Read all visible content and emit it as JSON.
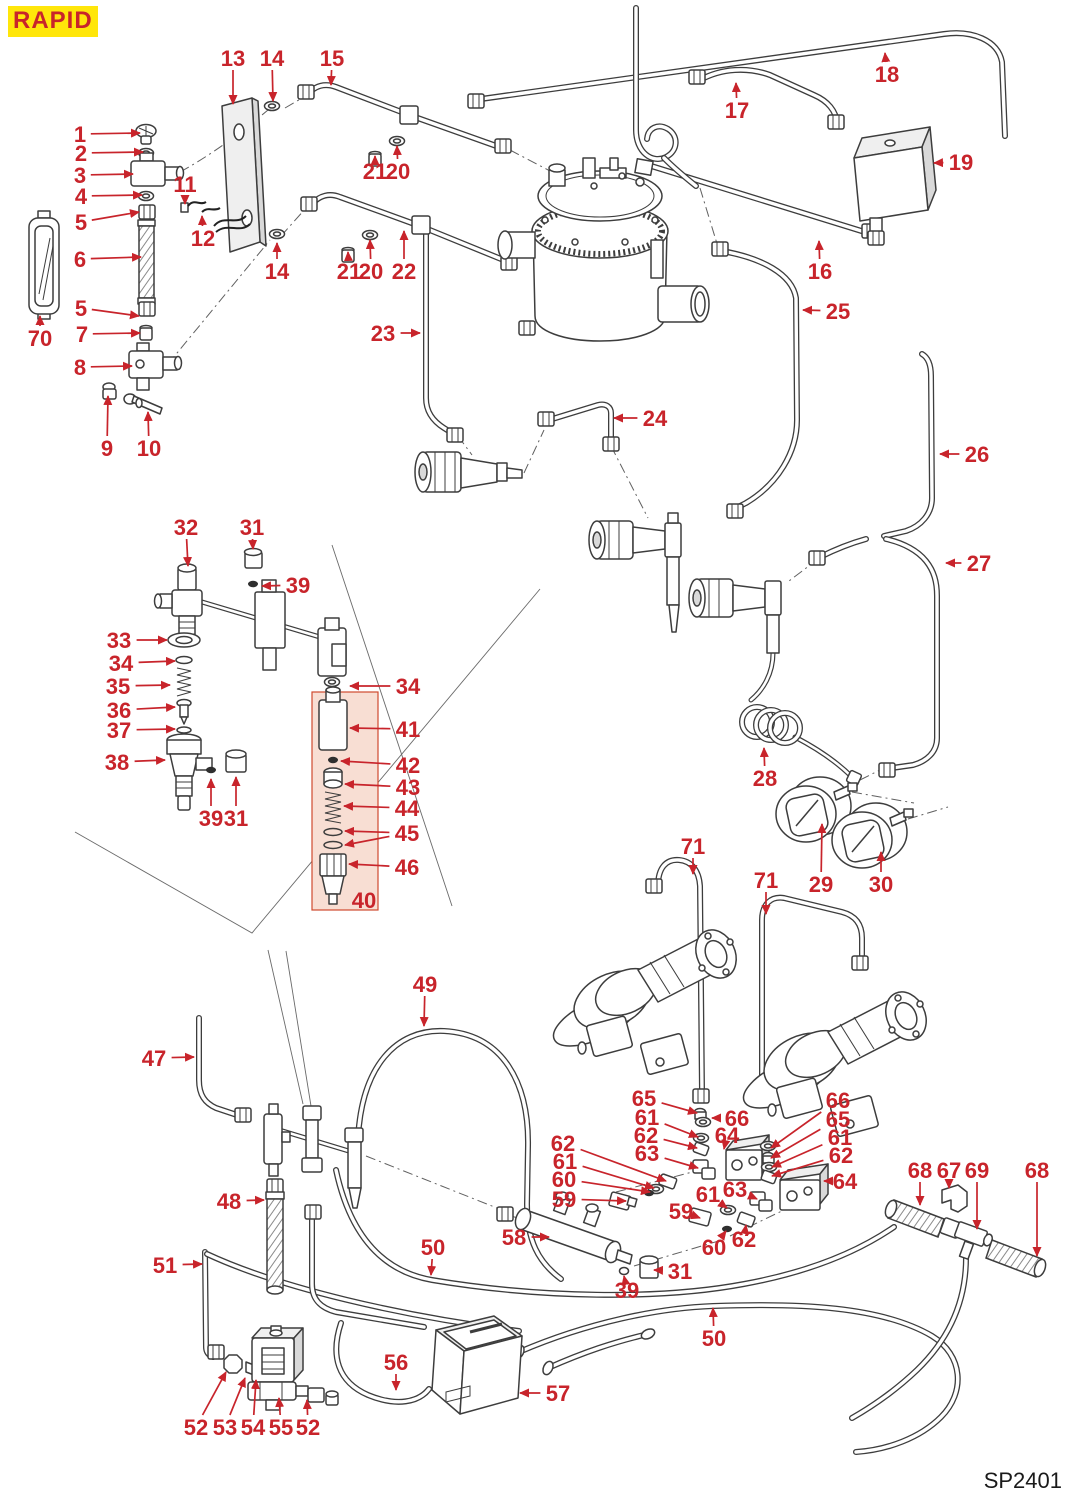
{
  "header": {
    "brand": "RAPID",
    "brand_bg": "#ffe60a",
    "brand_color": "#c8242b"
  },
  "footer": {
    "plate_code": "SP2401"
  },
  "colors": {
    "callout": "#c8242b",
    "line_art": "#3d3d3d",
    "highlight_box_fill": "#f8ded3",
    "highlight_box_border": "#cf4a2e"
  },
  "highlight_box": {
    "x": 312,
    "y": 692,
    "w": 66,
    "h": 218,
    "contains_items": "40-46"
  },
  "callouts": [
    {
      "t": "1",
      "x": 80,
      "y": 134,
      "tips": [
        [
          140,
          133
        ]
      ]
    },
    {
      "t": "2",
      "x": 81,
      "y": 153,
      "tips": [
        [
          143,
          152
        ]
      ]
    },
    {
      "t": "3",
      "x": 80,
      "y": 175,
      "tips": [
        [
          133,
          174
        ]
      ]
    },
    {
      "t": "4",
      "x": 81,
      "y": 196,
      "tips": [
        [
          142,
          195
        ]
      ]
    },
    {
      "t": "5",
      "x": 81,
      "y": 222,
      "tips": [
        [
          139,
          212
        ]
      ]
    },
    {
      "t": "6",
      "x": 80,
      "y": 259,
      "tips": [
        [
          141,
          257
        ]
      ]
    },
    {
      "t": "70",
      "x": 40,
      "y": 338,
      "tips": [
        [
          40,
          316
        ]
      ]
    },
    {
      "t": "5",
      "x": 81,
      "y": 308,
      "tips": [
        [
          139,
          316
        ]
      ]
    },
    {
      "t": "7",
      "x": 82,
      "y": 334,
      "tips": [
        [
          140,
          333
        ]
      ]
    },
    {
      "t": "8",
      "x": 80,
      "y": 367,
      "tips": [
        [
          132,
          366
        ]
      ]
    },
    {
      "t": "9",
      "x": 107,
      "y": 448,
      "tips": [
        [
          108,
          396
        ]
      ]
    },
    {
      "t": "10",
      "x": 149,
      "y": 448,
      "tips": [
        [
          148,
          412
        ]
      ]
    },
    {
      "t": "11",
      "x": 185,
      "y": 184,
      "tips": [
        [
          185,
          204
        ]
      ]
    },
    {
      "t": "12",
      "x": 203,
      "y": 238,
      "tips": [
        [
          202,
          216
        ]
      ]
    },
    {
      "t": "13",
      "x": 233,
      "y": 58,
      "tips": [
        [
          233,
          104
        ]
      ]
    },
    {
      "t": "14",
      "x": 272,
      "y": 58,
      "tips": [
        [
          273,
          101
        ]
      ]
    },
    {
      "t": "15",
      "x": 332,
      "y": 58,
      "tips": [
        [
          331,
          85
        ]
      ]
    },
    {
      "t": "14",
      "x": 277,
      "y": 271,
      "tips": [
        [
          277,
          243
        ]
      ]
    },
    {
      "t": "21",
      "x": 375,
      "y": 171,
      "tips": [
        [
          375,
          156
        ]
      ]
    },
    {
      "t": "20",
      "x": 398,
      "y": 171,
      "tips": [
        [
          397,
          146
        ]
      ]
    },
    {
      "t": "21",
      "x": 349,
      "y": 271,
      "tips": [
        [
          348,
          252
        ]
      ]
    },
    {
      "t": "20",
      "x": 371,
      "y": 271,
      "tips": [
        [
          370,
          240
        ]
      ]
    },
    {
      "t": "22",
      "x": 404,
      "y": 271,
      "tips": [
        [
          404,
          231
        ]
      ]
    },
    {
      "t": "23",
      "x": 383,
      "y": 333,
      "tips": [
        [
          420,
          333
        ]
      ]
    },
    {
      "t": "24",
      "x": 655,
      "y": 418,
      "tips": [
        [
          614,
          418
        ]
      ]
    },
    {
      "t": "17",
      "x": 737,
      "y": 110,
      "tips": [
        [
          736,
          83
        ]
      ]
    },
    {
      "t": "18",
      "x": 887,
      "y": 74,
      "tips": [
        [
          885,
          53
        ]
      ]
    },
    {
      "t": "19",
      "x": 961,
      "y": 162,
      "tips": [
        [
          934,
          163
        ]
      ]
    },
    {
      "t": "16",
      "x": 820,
      "y": 271,
      "tips": [
        [
          819,
          241
        ]
      ]
    },
    {
      "t": "25",
      "x": 838,
      "y": 311,
      "tips": [
        [
          803,
          310
        ]
      ]
    },
    {
      "t": "26",
      "x": 977,
      "y": 454,
      "tips": [
        [
          940,
          454
        ]
      ]
    },
    {
      "t": "27",
      "x": 979,
      "y": 563,
      "tips": [
        [
          946,
          563
        ]
      ]
    },
    {
      "t": "28",
      "x": 765,
      "y": 778,
      "tips": [
        [
          764,
          748
        ]
      ]
    },
    {
      "t": "29",
      "x": 821,
      "y": 884,
      "tips": [
        [
          822,
          824
        ]
      ]
    },
    {
      "t": "30",
      "x": 881,
      "y": 884,
      "tips": [
        [
          881,
          852
        ]
      ]
    },
    {
      "t": "71",
      "x": 693,
      "y": 846,
      "tips": [
        [
          693,
          874
        ]
      ]
    },
    {
      "t": "71",
      "x": 766,
      "y": 880,
      "tips": [
        [
          766,
          914
        ]
      ]
    },
    {
      "t": "32",
      "x": 186,
      "y": 527,
      "tips": [
        [
          188,
          566
        ]
      ]
    },
    {
      "t": "31",
      "x": 252,
      "y": 527,
      "tips": [
        [
          253,
          549
        ]
      ]
    },
    {
      "t": "39",
      "x": 298,
      "y": 585,
      "tips": [
        [
          262,
          586
        ]
      ]
    },
    {
      "t": "33",
      "x": 119,
      "y": 640,
      "tips": [
        [
          167,
          640
        ]
      ]
    },
    {
      "t": "34",
      "x": 121,
      "y": 663,
      "tips": [
        [
          175,
          661
        ]
      ]
    },
    {
      "t": "35",
      "x": 118,
      "y": 686,
      "tips": [
        [
          170,
          685
        ]
      ]
    },
    {
      "t": "36",
      "x": 119,
      "y": 710,
      "tips": [
        [
          175,
          707
        ]
      ]
    },
    {
      "t": "37",
      "x": 119,
      "y": 730,
      "tips": [
        [
          175,
          729
        ]
      ]
    },
    {
      "t": "38",
      "x": 117,
      "y": 762,
      "tips": [
        [
          165,
          760
        ]
      ]
    },
    {
      "t": "34",
      "x": 408,
      "y": 686,
      "tips": [
        [
          350,
          686
        ]
      ]
    },
    {
      "t": "41",
      "x": 408,
      "y": 729,
      "tips": [
        [
          350,
          728
        ]
      ]
    },
    {
      "t": "42",
      "x": 408,
      "y": 765,
      "tips": [
        [
          341,
          761
        ]
      ]
    },
    {
      "t": "43",
      "x": 408,
      "y": 787,
      "tips": [
        [
          345,
          784
        ]
      ]
    },
    {
      "t": "44",
      "x": 407,
      "y": 808,
      "tips": [
        [
          344,
          806
        ]
      ]
    },
    {
      "t": "45",
      "x": 407,
      "y": 833,
      "tips": [
        [
          345,
          831
        ],
        [
          345,
          845
        ]
      ]
    },
    {
      "t": "46",
      "x": 407,
      "y": 867,
      "tips": [
        [
          349,
          864
        ]
      ]
    },
    {
      "t": "40",
      "x": 364,
      "y": 900,
      "tips": []
    },
    {
      "t": "39",
      "x": 211,
      "y": 818,
      "tips": [
        [
          211,
          779
        ]
      ]
    },
    {
      "t": "31",
      "x": 236,
      "y": 818,
      "tips": [
        [
          236,
          777
        ]
      ]
    },
    {
      "t": "49",
      "x": 425,
      "y": 984,
      "tips": [
        [
          424,
          1026
        ]
      ]
    },
    {
      "t": "47",
      "x": 154,
      "y": 1058,
      "tips": [
        [
          194,
          1057
        ]
      ]
    },
    {
      "t": "48",
      "x": 229,
      "y": 1201,
      "tips": [
        [
          264,
          1200
        ]
      ]
    },
    {
      "t": "51",
      "x": 165,
      "y": 1265,
      "tips": [
        [
          202,
          1264
        ]
      ]
    },
    {
      "t": "50",
      "x": 433,
      "y": 1247,
      "tips": [
        [
          431,
          1275
        ]
      ]
    },
    {
      "t": "50",
      "x": 714,
      "y": 1338,
      "tips": [
        [
          713,
          1308
        ]
      ]
    },
    {
      "t": "52",
      "x": 196,
      "y": 1427,
      "tips": [
        [
          226,
          1372
        ]
      ]
    },
    {
      "t": "53",
      "x": 225,
      "y": 1427,
      "tips": [
        [
          245,
          1378
        ]
      ]
    },
    {
      "t": "54",
      "x": 253,
      "y": 1427,
      "tips": [
        [
          256,
          1380
        ]
      ]
    },
    {
      "t": "55",
      "x": 281,
      "y": 1427,
      "tips": [
        [
          279,
          1398
        ]
      ]
    },
    {
      "t": "52",
      "x": 308,
      "y": 1427,
      "tips": [
        [
          307,
          1400
        ]
      ]
    },
    {
      "t": "56",
      "x": 396,
      "y": 1362,
      "tips": [
        [
          396,
          1390
        ]
      ]
    },
    {
      "t": "57",
      "x": 558,
      "y": 1393,
      "tips": [
        [
          520,
          1393
        ]
      ]
    },
    {
      "t": "58",
      "x": 514,
      "y": 1237,
      "tips": [
        [
          549,
          1237
        ]
      ]
    },
    {
      "t": "59",
      "x": 564,
      "y": 1199,
      "tips": [
        [
          626,
          1201
        ]
      ]
    },
    {
      "t": "60",
      "x": 564,
      "y": 1179,
      "tips": [
        [
          650,
          1192
        ]
      ]
    },
    {
      "t": "61",
      "x": 565,
      "y": 1161,
      "tips": [
        [
          654,
          1188
        ]
      ]
    },
    {
      "t": "62",
      "x": 563,
      "y": 1143,
      "tips": [
        [
          666,
          1181
        ]
      ]
    },
    {
      "t": "65",
      "x": 644,
      "y": 1098,
      "tips": [
        [
          697,
          1113
        ]
      ]
    },
    {
      "t": "61",
      "x": 647,
      "y": 1117,
      "tips": [
        [
          698,
          1137
        ]
      ]
    },
    {
      "t": "62",
      "x": 646,
      "y": 1135,
      "tips": [
        [
          697,
          1148
        ]
      ]
    },
    {
      "t": "63",
      "x": 647,
      "y": 1153,
      "tips": [
        [
          698,
          1168
        ]
      ]
    },
    {
      "t": "66",
      "x": 737,
      "y": 1118,
      "tips": [
        [
          712,
          1118
        ]
      ]
    },
    {
      "t": "64",
      "x": 727,
      "y": 1135,
      "tips": [
        [
          724,
          1149
        ]
      ]
    },
    {
      "t": "66",
      "x": 838,
      "y": 1100,
      "tips": [
        [
          771,
          1148
        ]
      ]
    },
    {
      "t": "65",
      "x": 838,
      "y": 1119,
      "tips": [
        [
          771,
          1158
        ]
      ]
    },
    {
      "t": "61",
      "x": 840,
      "y": 1137,
      "tips": [
        [
          772,
          1167
        ]
      ]
    },
    {
      "t": "62",
      "x": 841,
      "y": 1155,
      "tips": [
        [
          772,
          1176
        ]
      ]
    },
    {
      "t": "64",
      "x": 845,
      "y": 1181,
      "tips": [
        [
          824,
          1181
        ]
      ]
    },
    {
      "t": "63",
      "x": 735,
      "y": 1189,
      "tips": [
        [
          757,
          1199
        ]
      ]
    },
    {
      "t": "61",
      "x": 708,
      "y": 1194,
      "tips": [
        [
          727,
          1208
        ]
      ]
    },
    {
      "t": "59",
      "x": 681,
      "y": 1211,
      "tips": [
        [
          700,
          1218
        ]
      ]
    },
    {
      "t": "60",
      "x": 714,
      "y": 1247,
      "tips": [
        [
          726,
          1231
        ]
      ]
    },
    {
      "t": "62",
      "x": 744,
      "y": 1239,
      "tips": [
        [
          746,
          1225
        ]
      ]
    },
    {
      "t": "31",
      "x": 680,
      "y": 1271,
      "tips": [
        [
          654,
          1270
        ]
      ]
    },
    {
      "t": "39",
      "x": 627,
      "y": 1290,
      "tips": [
        [
          624,
          1276
        ]
      ]
    },
    {
      "t": "68",
      "x": 920,
      "y": 1170,
      "tips": [
        [
          920,
          1205
        ]
      ]
    },
    {
      "t": "67",
      "x": 949,
      "y": 1170,
      "tips": [
        [
          949,
          1188
        ]
      ]
    },
    {
      "t": "69",
      "x": 977,
      "y": 1170,
      "tips": [
        [
          977,
          1229
        ]
      ]
    },
    {
      "t": "68",
      "x": 1037,
      "y": 1170,
      "tips": [
        [
          1037,
          1256
        ]
      ]
    }
  ]
}
